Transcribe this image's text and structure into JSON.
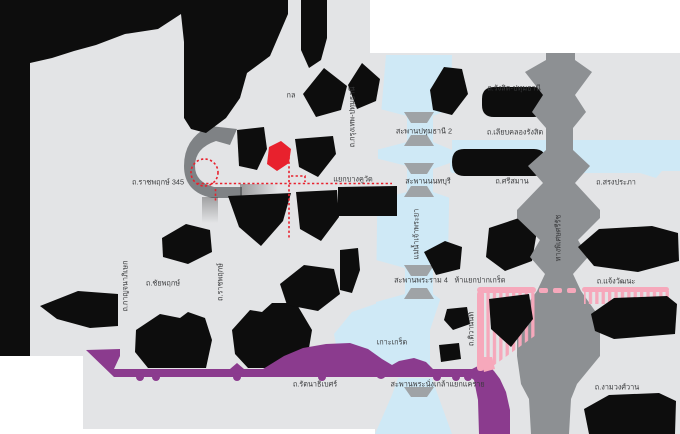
{
  "map": {
    "description": "Location map of Pathum Thani / Nonthaburi area with highlighted route",
    "colors": {
      "page_background": "#ffffff",
      "canvas": "#e3e4e6",
      "land_block": "#0d0d0d",
      "water": "#cfe9f6",
      "expressway_gray": "#8d9093",
      "road_gray": "#7f8285",
      "bridge_gray": "#9fa3a6",
      "road_purple": "#8b3b8e",
      "road_pink": "#f6a8bb",
      "route_highlight_red": "#e8212d",
      "label_text": "#38393b"
    },
    "labels": [
      {
        "id": "ratchaphruek-345",
        "text": "ถ.ราชพฤกษ์ 345",
        "x": 158,
        "y": 182,
        "rot": 0
      },
      {
        "id": "bang-khu-wat-junction",
        "text": "แยกบางคูวัด",
        "x": 353,
        "y": 179,
        "rot": 0
      },
      {
        "id": "krungthep-pathumthani-rd",
        "text": "ถ.กรุงเทพ-ปทุมธานี",
        "x": 352,
        "y": 117,
        "rot": -90
      },
      {
        "id": "pathumthani2-bridge",
        "text": "สะพานปทุมธานี 2",
        "x": 424,
        "y": 131,
        "rot": 0
      },
      {
        "id": "rangsit-pathumthani-rd",
        "text": "ถ.รังสิต-ปทุมธานี",
        "x": 514,
        "y": 88,
        "rot": 0
      },
      {
        "id": "liab-khlong-rangsit-rd",
        "text": "ถ.เลียบคลองรังสิต",
        "x": 515,
        "y": 132,
        "rot": 0
      },
      {
        "id": "nonthaburi-bridge",
        "text": "สะพานนนทบุรี",
        "x": 428,
        "y": 181,
        "rot": 0
      },
      {
        "id": "si-saman-rd",
        "text": "ถ.ศรีสมาน",
        "x": 512,
        "y": 181,
        "rot": 0
      },
      {
        "id": "song-prapha-rd",
        "text": "ถ.สรงประภา",
        "x": 616,
        "y": 182,
        "rot": 0
      },
      {
        "id": "chao-phraya-river",
        "text": "แม่น้ำเจ้าพระยา",
        "x": 416,
        "y": 234,
        "rot": -90
      },
      {
        "id": "rama4-bridge",
        "text": "สะพานพระราม 4",
        "x": 421,
        "y": 280,
        "rot": 0
      },
      {
        "id": "pak-kret-junction",
        "text": "ห้าแยกปากเกร็ด",
        "x": 480,
        "y": 280,
        "rot": 0
      },
      {
        "id": "chaengwattana-rd",
        "text": "ถ.แจ้งวัฒนะ",
        "x": 616,
        "y": 281,
        "rot": 0
      },
      {
        "id": "si-rat-expressway",
        "text": "ทางพิเศษศรีรัช",
        "x": 558,
        "y": 238,
        "rot": -90
      },
      {
        "id": "koh-kret",
        "text": "เกาะเกร็ด",
        "x": 392,
        "y": 342,
        "rot": 0
      },
      {
        "id": "tiwanon-rd",
        "text": "ถ.ติวานนท์",
        "x": 471,
        "y": 329,
        "rot": -90
      },
      {
        "id": "ratchaphruek-rd",
        "text": "ถ.ราชพฤกษ์",
        "x": 220,
        "y": 282,
        "rot": -90
      },
      {
        "id": "chaiyapruek-rd",
        "text": "ถ.ชัยพฤกษ์",
        "x": 163,
        "y": 283,
        "rot": 0
      },
      {
        "id": "kanchanaphisek-rd",
        "text": "ถ.กาญจนาภิเษก",
        "x": 125,
        "y": 286,
        "rot": -90
      },
      {
        "id": "rattanathibet-rd",
        "text": "ถ.รัตนาธิเบศร์",
        "x": 315,
        "y": 384,
        "rot": 0
      },
      {
        "id": "phra-nangklao-bridge",
        "text": "สะพานพระนั่งเกล้า",
        "x": 420,
        "y": 384,
        "rot": 0
      },
      {
        "id": "khae-rai-junction",
        "text": "แยกแคราย",
        "x": 467,
        "y": 384,
        "rot": 0
      },
      {
        "id": "ngam-wong-wan-rd",
        "text": "ถ.งามวงศ์วาน",
        "x": 617,
        "y": 387,
        "rot": 0
      },
      {
        "id": "obscured-label-fragment",
        "text": "กล",
        "x": 291,
        "y": 95,
        "rot": 0
      }
    ]
  }
}
